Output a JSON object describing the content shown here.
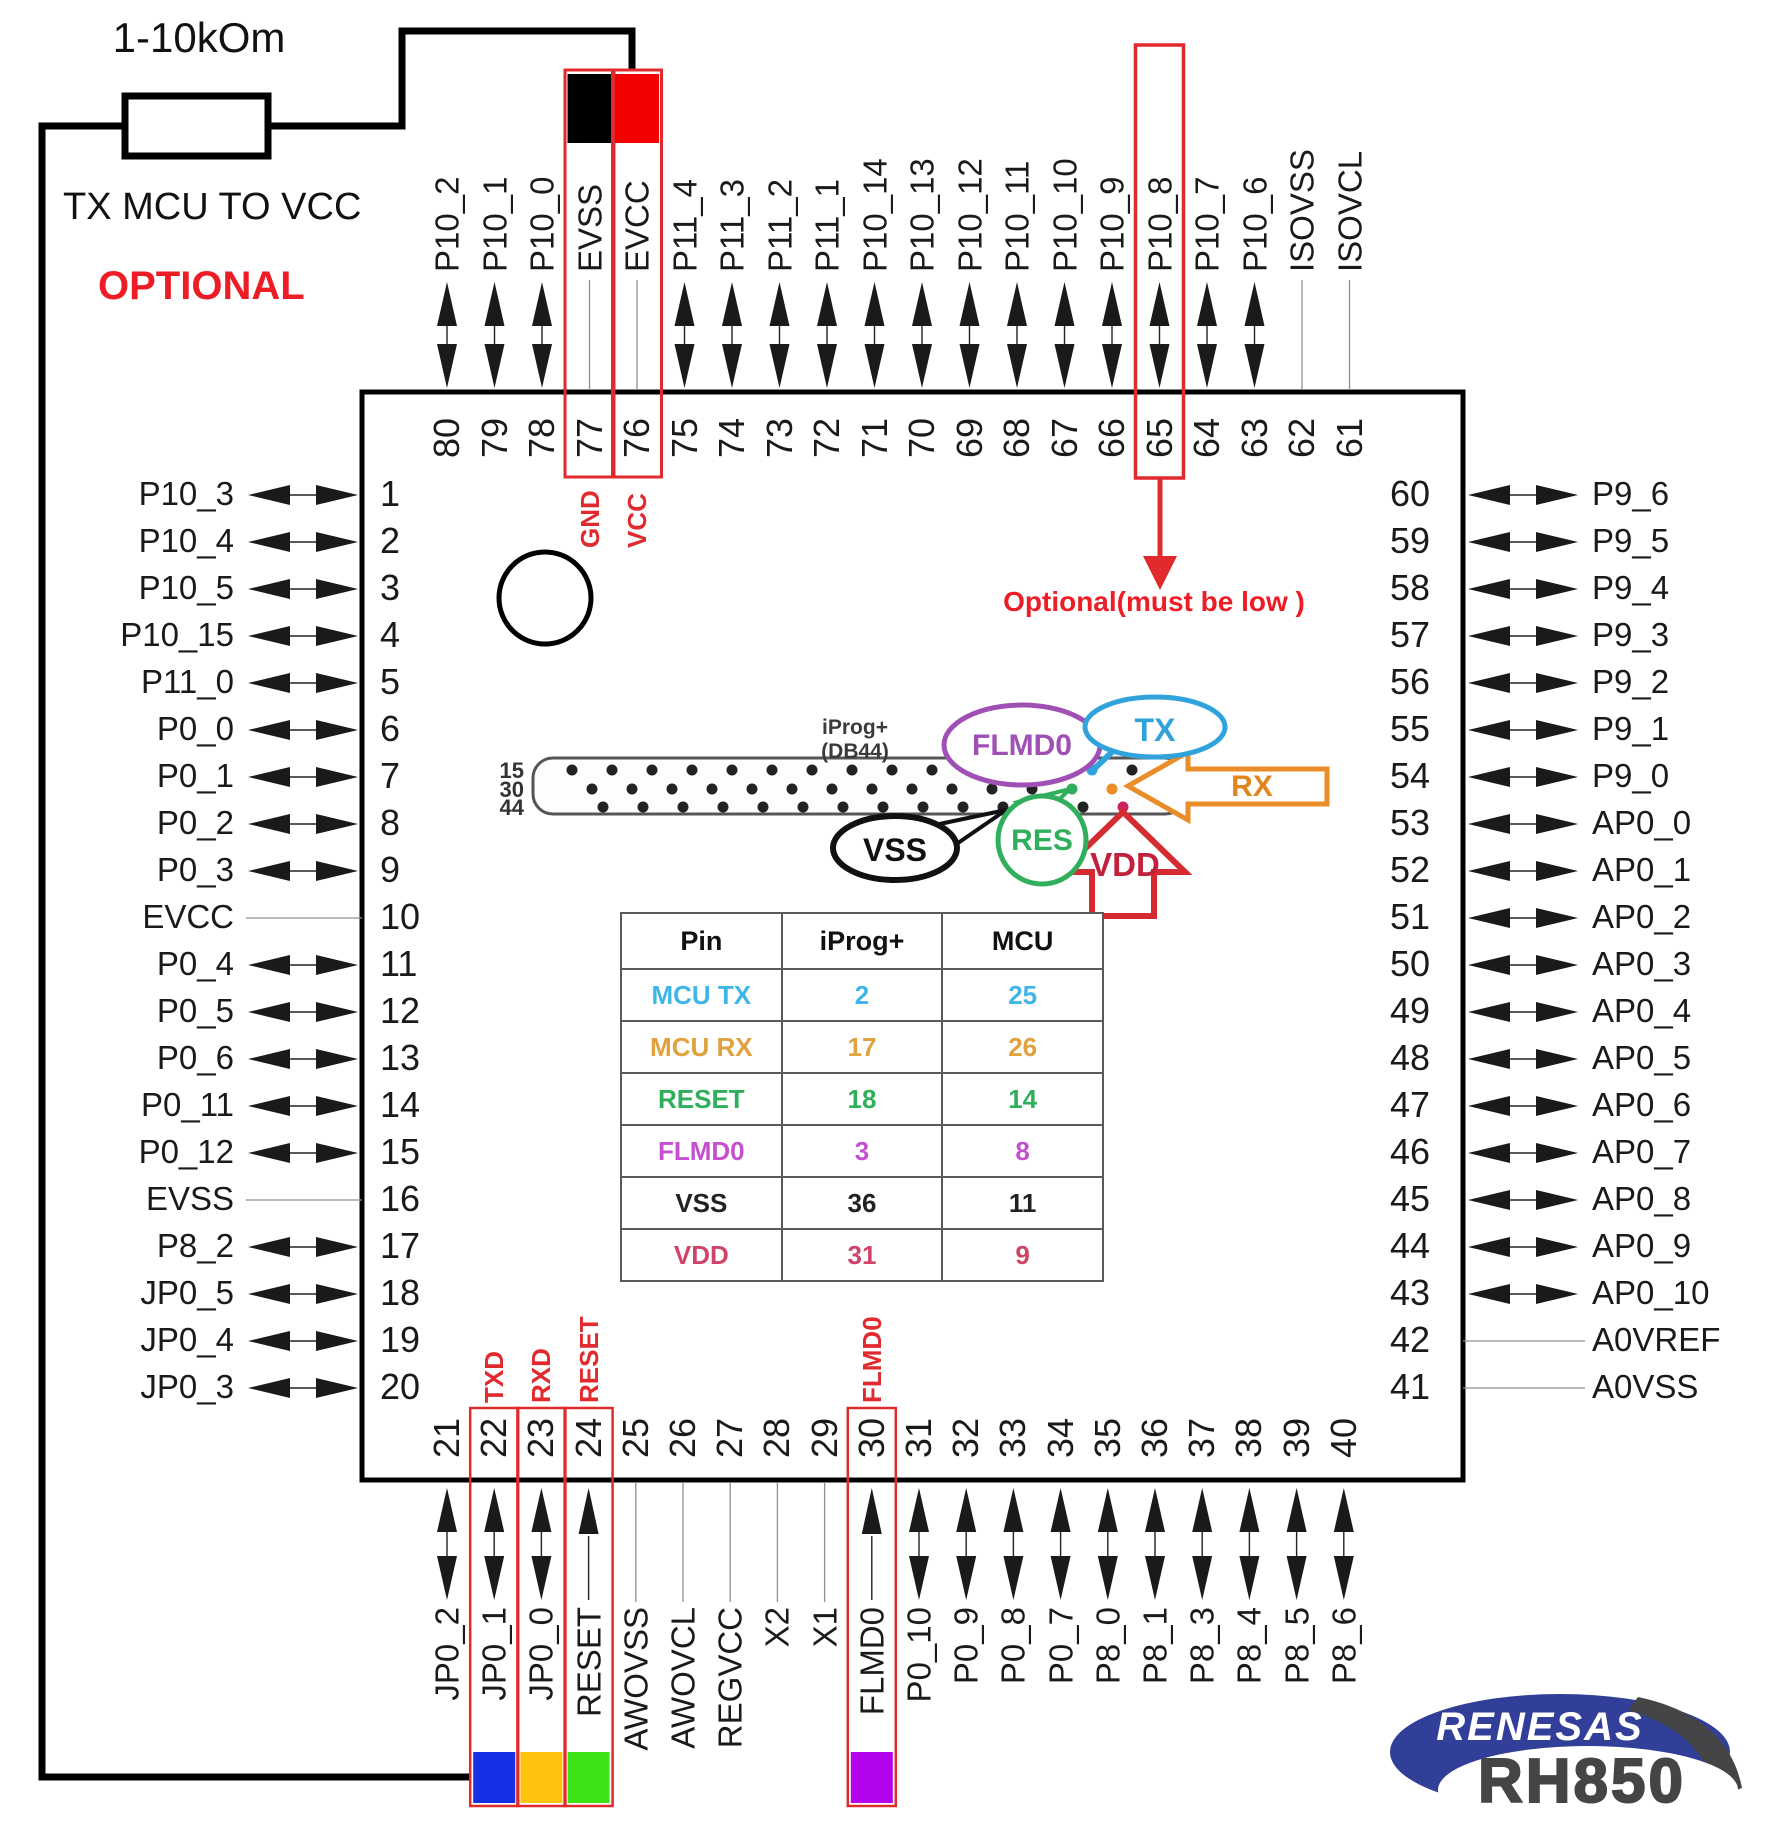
{
  "colors": {
    "highlight_red": "#e02a2e",
    "text_black": "#1a1a1a",
    "line_gray": "#909090",
    "swatch_blue": "#1630e6",
    "swatch_yellow": "#ffc20e",
    "swatch_green": "#3fe214",
    "swatch_purple": "#b303ef",
    "optional_red": "#ee1c25",
    "bubble_purple": "#a050b4",
    "bubble_blue": "#31a3dc",
    "bubble_green": "#2fae5c",
    "arrow_orange": "#ea8c28",
    "arrow_red": "#d42a30",
    "logo_blue": "#323f99",
    "logo_gray": "#454547"
  },
  "annotations": {
    "resistor_label": "1-10kOm",
    "wire_note": "TX MCU TO VCC",
    "optional_note": "OPTIONAL",
    "pin65_note": "Optional(must be low )"
  },
  "chip": {
    "top_pins": [
      {
        "num": "80",
        "label": "P10_2",
        "conn": "bi"
      },
      {
        "num": "79",
        "label": "P10_1",
        "conn": "bi"
      },
      {
        "num": "78",
        "label": "P10_0",
        "conn": "bi"
      },
      {
        "num": "77",
        "label": "EVSS",
        "conn": "line",
        "box": true,
        "box_fill": "#000000",
        "tag": "GND"
      },
      {
        "num": "76",
        "label": "EVCC",
        "conn": "line",
        "box": true,
        "box_fill": "#f40000",
        "tag": "VCC"
      },
      {
        "num": "75",
        "label": "P11_4",
        "conn": "bi"
      },
      {
        "num": "74",
        "label": "P11_3",
        "conn": "bi"
      },
      {
        "num": "73",
        "label": "P11_2",
        "conn": "bi"
      },
      {
        "num": "72",
        "label": "P11_1",
        "conn": "bi"
      },
      {
        "num": "71",
        "label": "P10_14",
        "conn": "bi"
      },
      {
        "num": "70",
        "label": "P10_13",
        "conn": "bi"
      },
      {
        "num": "69",
        "label": "P10_12",
        "conn": "bi"
      },
      {
        "num": "68",
        "label": "P10_11",
        "conn": "bi"
      },
      {
        "num": "67",
        "label": "P10_10",
        "conn": "bi"
      },
      {
        "num": "66",
        "label": "P10_9",
        "conn": "bi"
      },
      {
        "num": "65",
        "label": "P10_8",
        "conn": "bi",
        "box65": true
      },
      {
        "num": "64",
        "label": "P10_7",
        "conn": "bi"
      },
      {
        "num": "63",
        "label": "P10_6",
        "conn": "bi"
      },
      {
        "num": "62",
        "label": "ISOVSS",
        "conn": "line"
      },
      {
        "num": "61",
        "label": "ISOVCL",
        "conn": "line"
      }
    ],
    "left_pins": [
      {
        "num": "1",
        "label": "P10_3",
        "conn": "bi"
      },
      {
        "num": "2",
        "label": "P10_4",
        "conn": "bi"
      },
      {
        "num": "3",
        "label": "P10_5",
        "conn": "bi"
      },
      {
        "num": "4",
        "label": "P10_15",
        "conn": "bi"
      },
      {
        "num": "5",
        "label": "P11_0",
        "conn": "bi"
      },
      {
        "num": "6",
        "label": "P0_0",
        "conn": "bi"
      },
      {
        "num": "7",
        "label": "P0_1",
        "conn": "bi"
      },
      {
        "num": "8",
        "label": "P0_2",
        "conn": "bi"
      },
      {
        "num": "9",
        "label": "P0_3",
        "conn": "bi"
      },
      {
        "num": "10",
        "label": "EVCC",
        "conn": "line"
      },
      {
        "num": "11",
        "label": "P0_4",
        "conn": "bi"
      },
      {
        "num": "12",
        "label": "P0_5",
        "conn": "bi"
      },
      {
        "num": "13",
        "label": "P0_6",
        "conn": "bi"
      },
      {
        "num": "14",
        "label": "P0_11",
        "conn": "bi"
      },
      {
        "num": "15",
        "label": "P0_12",
        "conn": "bi"
      },
      {
        "num": "16",
        "label": "EVSS",
        "conn": "line"
      },
      {
        "num": "17",
        "label": "P8_2",
        "conn": "bi"
      },
      {
        "num": "18",
        "label": "JP0_5",
        "conn": "bi"
      },
      {
        "num": "19",
        "label": "JP0_4",
        "conn": "bi"
      },
      {
        "num": "20",
        "label": "JP0_3",
        "conn": "bi"
      }
    ],
    "right_pins": [
      {
        "num": "60",
        "label": "P9_6",
        "conn": "bi"
      },
      {
        "num": "59",
        "label": "P9_5",
        "conn": "bi"
      },
      {
        "num": "58",
        "label": "P9_4",
        "conn": "bi"
      },
      {
        "num": "57",
        "label": "P9_3",
        "conn": "bi"
      },
      {
        "num": "56",
        "label": "P9_2",
        "conn": "bi"
      },
      {
        "num": "55",
        "label": "P9_1",
        "conn": "bi"
      },
      {
        "num": "54",
        "label": "P9_0",
        "conn": "bi"
      },
      {
        "num": "53",
        "label": "AP0_0",
        "conn": "bi"
      },
      {
        "num": "52",
        "label": "AP0_1",
        "conn": "bi"
      },
      {
        "num": "51",
        "label": "AP0_2",
        "conn": "bi"
      },
      {
        "num": "50",
        "label": "AP0_3",
        "conn": "bi"
      },
      {
        "num": "49",
        "label": "AP0_4",
        "conn": "bi"
      },
      {
        "num": "48",
        "label": "AP0_5",
        "conn": "bi"
      },
      {
        "num": "47",
        "label": "AP0_6",
        "conn": "bi"
      },
      {
        "num": "46",
        "label": "AP0_7",
        "conn": "bi"
      },
      {
        "num": "45",
        "label": "AP0_8",
        "conn": "bi"
      },
      {
        "num": "44",
        "label": "AP0_9",
        "conn": "bi"
      },
      {
        "num": "43",
        "label": "AP0_10",
        "conn": "bi"
      },
      {
        "num": "42",
        "label": "A0VREF",
        "conn": "line"
      },
      {
        "num": "41",
        "label": "A0VSS",
        "conn": "line"
      }
    ],
    "bottom_pins": [
      {
        "num": "21",
        "label": "JP0_2",
        "conn": "bi"
      },
      {
        "num": "22",
        "label": "JP0_1",
        "conn": "bi",
        "box": true,
        "swatch": "#1630e6",
        "tag": "TXD"
      },
      {
        "num": "23",
        "label": "JP0_0",
        "conn": "bi",
        "box": true,
        "swatch": "#ffc20e",
        "tag": "RXD"
      },
      {
        "num": "24",
        "label": "RESET",
        "conn": "in",
        "box": true,
        "swatch": "#3fe214",
        "tag": "RESET"
      },
      {
        "num": "25",
        "label": "AWOVSS",
        "conn": "line"
      },
      {
        "num": "26",
        "label": "AWOVCL",
        "conn": "line"
      },
      {
        "num": "27",
        "label": "REGVCC",
        "conn": "line"
      },
      {
        "num": "28",
        "label": "X2",
        "conn": "line"
      },
      {
        "num": "29",
        "label": "X1",
        "conn": "line"
      },
      {
        "num": "30",
        "label": "FLMD0",
        "conn": "in",
        "box": true,
        "swatch": "#b303ef",
        "tag": "FLMD0"
      },
      {
        "num": "31",
        "label": "P0_10",
        "conn": "bi"
      },
      {
        "num": "32",
        "label": "P0_9",
        "conn": "bi"
      },
      {
        "num": "33",
        "label": "P0_8",
        "conn": "bi"
      },
      {
        "num": "34",
        "label": "P0_7",
        "conn": "bi"
      },
      {
        "num": "35",
        "label": "P8_0",
        "conn": "bi"
      },
      {
        "num": "36",
        "label": "P8_1",
        "conn": "bi"
      },
      {
        "num": "37",
        "label": "P8_3",
        "conn": "bi"
      },
      {
        "num": "38",
        "label": "P8_4",
        "conn": "bi"
      },
      {
        "num": "39",
        "label": "P8_5",
        "conn": "bi"
      },
      {
        "num": "40",
        "label": "P8_6",
        "conn": "bi"
      }
    ]
  },
  "connector": {
    "title_line1": "iProg+",
    "title_line2": "(DB44)",
    "row_labels": [
      "15",
      "30",
      "44"
    ],
    "row_counts": [
      15,
      14,
      14
    ],
    "special_dots": [
      {
        "row": 0,
        "dot": 12,
        "color": "#a050b4"
      },
      {
        "row": 0,
        "dot": 13,
        "color": "#31a3dc"
      },
      {
        "row": 1,
        "dot": 12,
        "color": "#2fae5c"
      },
      {
        "row": 1,
        "dot": 13,
        "color": "#ea8c28"
      },
      {
        "row": 2,
        "dot": 13,
        "color": "#cc2358"
      }
    ],
    "callouts": {
      "flmd0": "FLMD0",
      "tx": "TX",
      "rx": "RX",
      "vss": "VSS",
      "res": "RES",
      "vdd": "VDD"
    }
  },
  "pin_map_table": {
    "headers": [
      "Pin",
      "iProg+",
      "MCU"
    ],
    "rows": [
      {
        "pin": "MCU TX",
        "iprog": "2",
        "mcu": "25",
        "color": "#3eb6e8"
      },
      {
        "pin": "MCU RX",
        "iprog": "17",
        "mcu": "26",
        "color": "#dfa23c"
      },
      {
        "pin": "RESET",
        "iprog": "18",
        "mcu": "14",
        "color": "#2fae5c"
      },
      {
        "pin": "FLMD0",
        "iprog": "3",
        "mcu": "8",
        "color": "#c44fd0"
      },
      {
        "pin": "VSS",
        "iprog": "36",
        "mcu": "11",
        "color": "#222222"
      },
      {
        "pin": "VDD",
        "iprog": "31",
        "mcu": "9",
        "color": "#d04468"
      }
    ]
  },
  "logo": {
    "brand": "RENESAS",
    "product": "RH850"
  }
}
